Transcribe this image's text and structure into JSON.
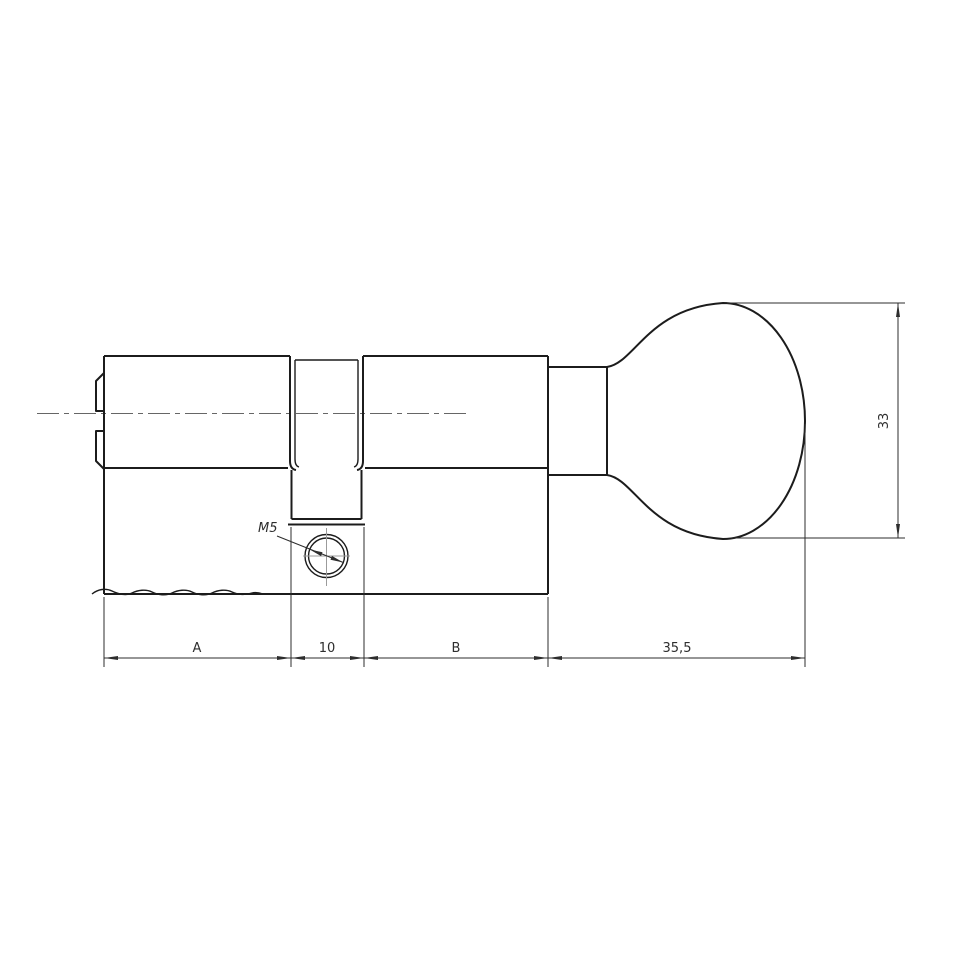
{
  "drawing": {
    "labels": {
      "dim_a": "A",
      "dim_slot_width": "10",
      "dim_b": "B",
      "dim_knob_length": "35,5",
      "dim_knob_height": "33",
      "thread_callout": "M5"
    },
    "colors": {
      "background": "#ffffff",
      "outline": "#1c1c1c",
      "dimension": "#2d2d2d",
      "centerline": "#666666",
      "crosshair": "#9b9b9b"
    }
  }
}
